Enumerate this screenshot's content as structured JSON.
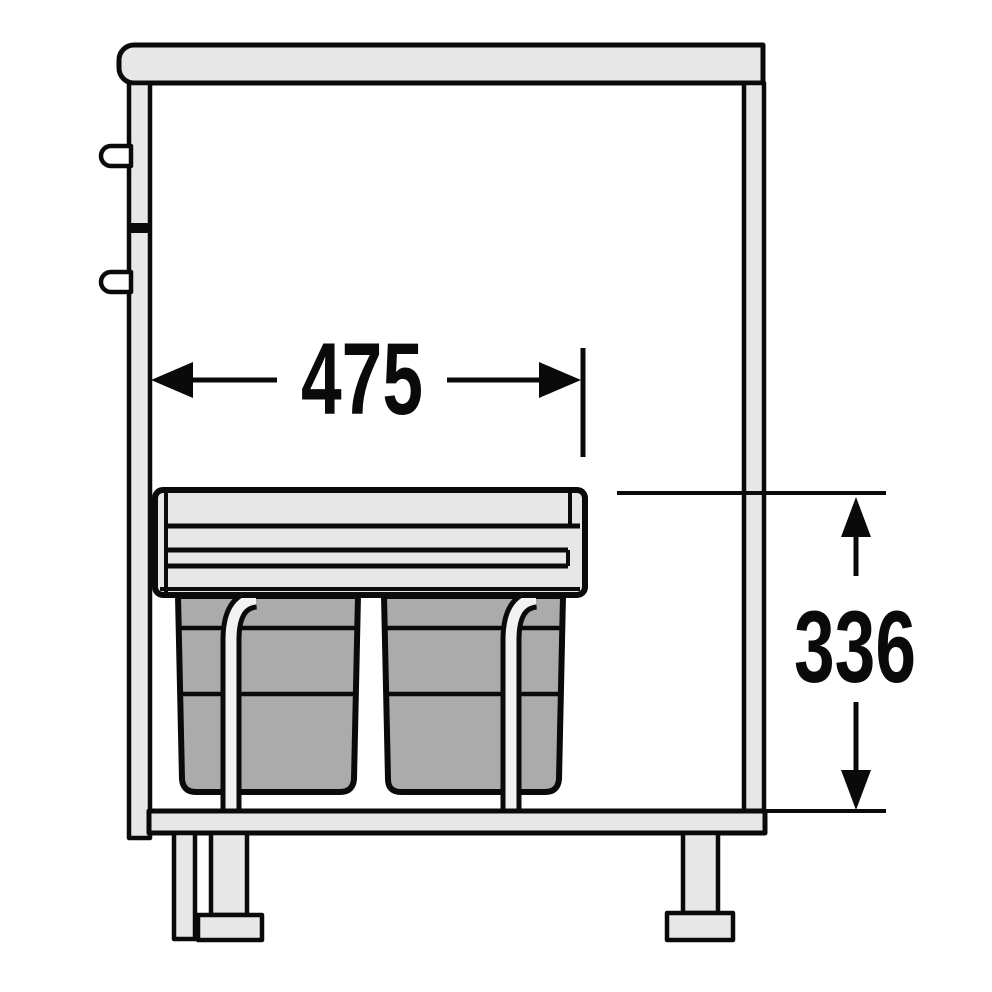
{
  "diagram": {
    "width_dimension": {
      "label": "475"
    },
    "height_dimension": {
      "label": "336"
    },
    "colors": {
      "outline": "#0a0a0a",
      "cabinet_fill": "#e7e7e7",
      "bin_fill": "#ababab",
      "rail_fill": "#f2f2f2",
      "background": "#ffffff"
    }
  }
}
